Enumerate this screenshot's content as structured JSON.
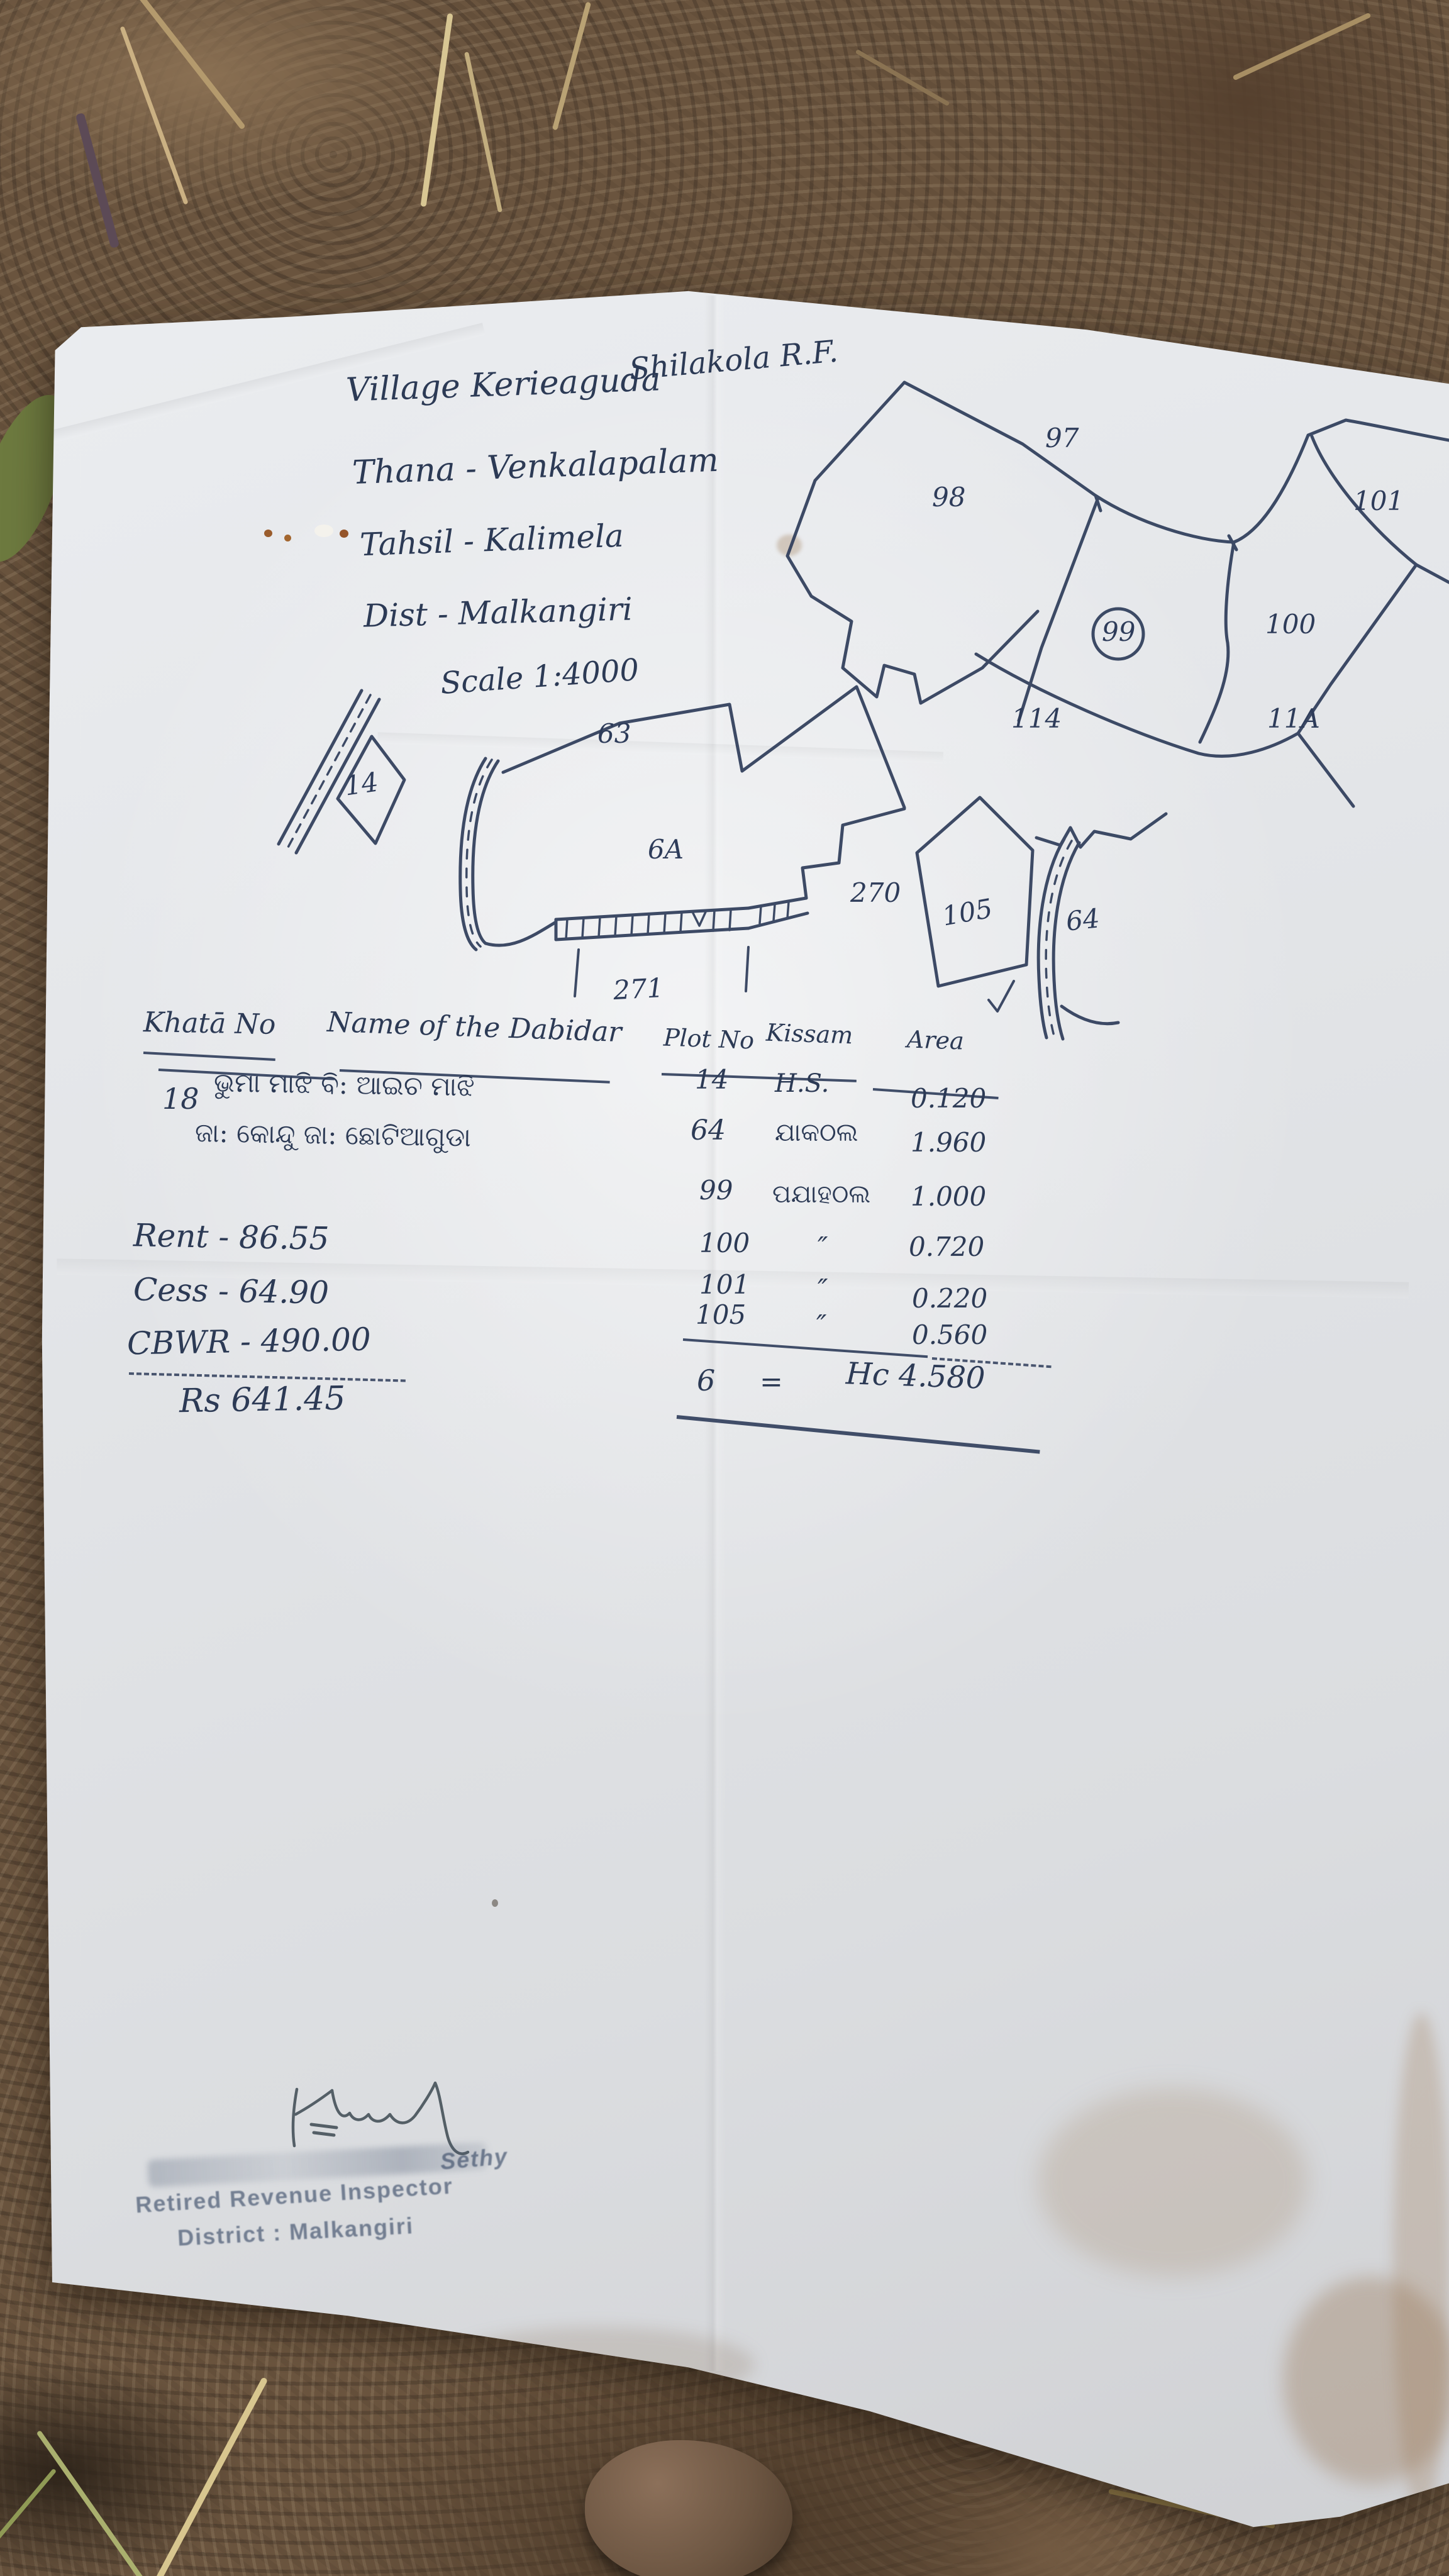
{
  "header": {
    "village_line": "Village Kerieaguda",
    "forest_block": "Shilakola R.F.",
    "thana_line": "Thana - Venkalapalam",
    "tahsil_line": "Tahsil - Kalimela",
    "district_line": "Dist - Malkangiri",
    "scale_line": "Scale 1:4000"
  },
  "map": {
    "labels": {
      "p97": "97",
      "p98": "98",
      "p99": "99",
      "p100": "100",
      "p101": "101",
      "p114": "114",
      "p11A": "11A",
      "p14": "14",
      "p63": "63",
      "p6A": "6A",
      "p270": "270",
      "p271": "271",
      "p105": "105",
      "p64": "64"
    }
  },
  "table": {
    "headers": {
      "khata": "Khatā No",
      "name": "Name of the Dabidar",
      "plot": "Plot No",
      "kissam": "Kissam",
      "area": "Area"
    },
    "khata_no": "18",
    "name_line1": "ଭୁମା ମାଝି ବି: ଆଇଚ ମାଝି",
    "name_line2": "ଜା: କୋନ୍ଦୁ ଜା: ଛୋଟିଆଗୁଡା",
    "rows": [
      {
        "plot": "14",
        "kissam": "H.S.",
        "area": "0.120"
      },
      {
        "plot": "64",
        "kissam": "ଯାକଠଲ",
        "area": "1.960"
      },
      {
        "plot": "99",
        "kissam": "ପଯାହଠଲ",
        "area": "1.000"
      },
      {
        "plot": "100",
        "kissam": "″",
        "area": "0.720"
      },
      {
        "plot": "101",
        "kissam": "″",
        "area": "0.220"
      },
      {
        "plot": "105",
        "kissam": "″",
        "area": "0.560"
      }
    ],
    "total_plots": "6",
    "total_equals": "=",
    "total_area": "Hc 4.580"
  },
  "charges": {
    "rent": "Rent - 86.55",
    "cess": "Cess - 64.90",
    "cbwr": "CBWR - 490.00",
    "total": "Rs 641.45"
  },
  "stamp": {
    "name_fragment": "Sethy",
    "line2": "Retired Revenue Inspector",
    "line3": "District : Malkangiri"
  }
}
